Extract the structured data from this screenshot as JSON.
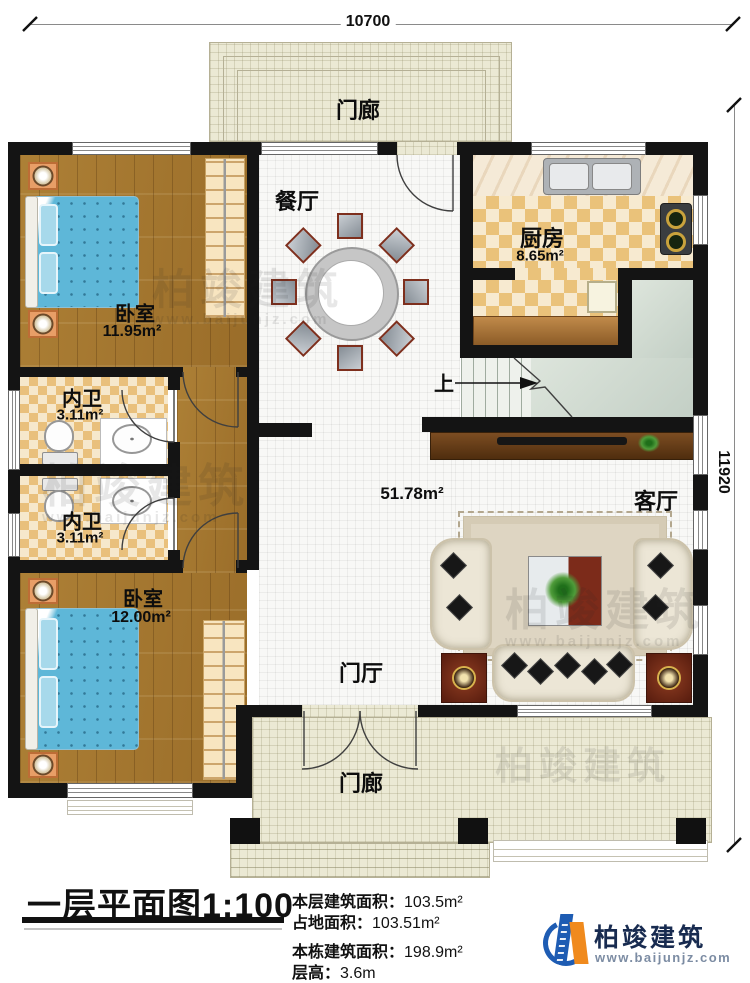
{
  "palette": {
    "wall_black": "#141414",
    "wood_floor": "#a57a31",
    "checker_tan": "#eac27a",
    "porch_floor": "#ebe9d4",
    "stair_landing": "#cdd7cd",
    "bed_blue": "#5eb7d8",
    "console_brown": "#5f3517",
    "red_wood": "#7c2b1a",
    "logo_blue": "#1e5cb3",
    "logo_orange": "#f08a1d"
  },
  "dimensions": {
    "top": "10700",
    "right": "11920"
  },
  "rooms": {
    "porch_top": "门廊",
    "porch_bottom": "门廊",
    "dining": "餐厅",
    "kitchen": "厨房",
    "kitchen_area": "8.65m²",
    "bedroom1": "卧室",
    "bedroom1_area": "11.95m²",
    "bath1": "内卫",
    "bath1_area": "3.11m²",
    "bath2": "内卫",
    "bath2_area": "3.11m²",
    "bedroom2": "卧室",
    "bedroom2_area": "12.00m²",
    "hall_area": "51.78m²",
    "living": "客厅",
    "foyer": "门厅",
    "stairs_up": "上"
  },
  "titleblock": {
    "title": "一层平面图1:100",
    "stats": [
      {
        "label": "本层建筑面积：",
        "value": "103.5m²"
      },
      {
        "label": "占地面积：",
        "value": "103.51m²"
      },
      {
        "label": "本栋建筑面积：",
        "value": "198.9m²"
      },
      {
        "label": "层高：",
        "value": "3.6m"
      }
    ]
  },
  "branding": {
    "name": "柏竣建筑",
    "website": "www.baijunjz.com"
  },
  "watermark": {
    "text": "柏竣建筑",
    "url": "www.baijunjz.com"
  }
}
